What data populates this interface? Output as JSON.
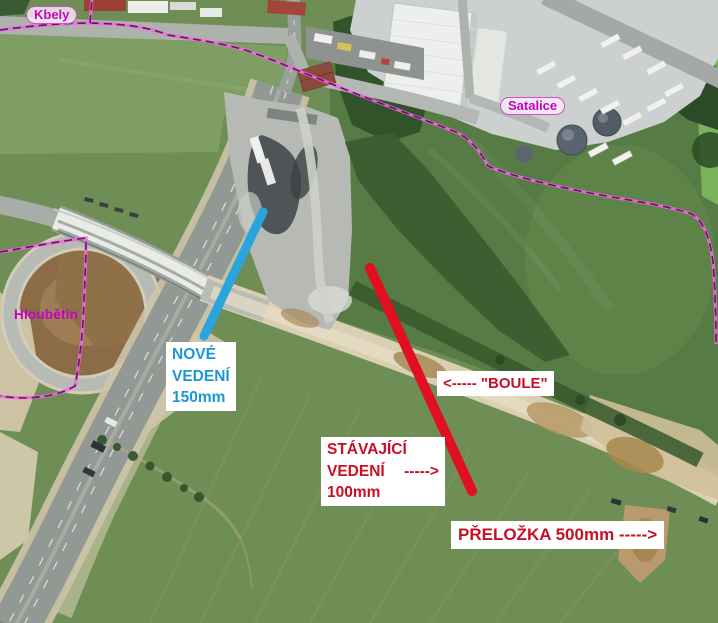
{
  "map": {
    "place_labels": {
      "kbely": "Kbely",
      "satalice": "Satalice",
      "hloubetin": "Hloubětin"
    },
    "annotations": {
      "new_line": {
        "lines": [
          "NOVÉ",
          "VEDENÍ",
          "150mm"
        ]
      },
      "existing_line": {
        "lines": [
          "STÁVAJÍCÍ",
          "VEDENÍ",
          "100mm"
        ],
        "arrow": "----->"
      },
      "boule": "<----- \"BOULE\"",
      "prelozka": "PŘELOŽKA 500mm ----->"
    },
    "colors": {
      "new_line_blue": "#2aa4df",
      "existing_line_red": "#e01020",
      "note_blue": "#1d96d2",
      "note_red": "#c70f26",
      "place_magenta": "#c400c4",
      "boundary_pink": "#ee6bd8",
      "boundary_purple": "#6d0c72"
    }
  }
}
